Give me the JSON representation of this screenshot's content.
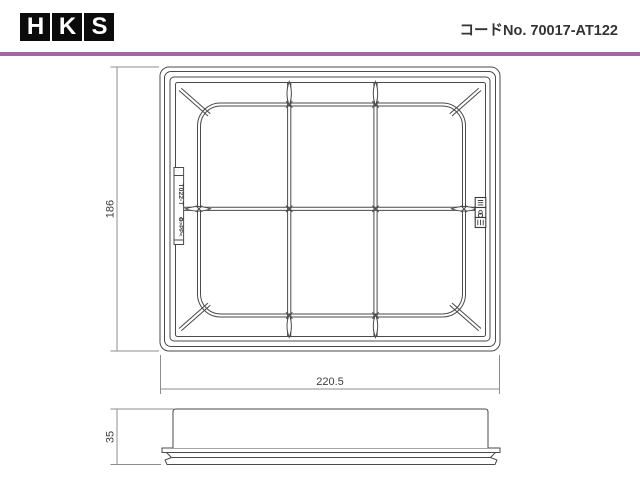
{
  "header": {
    "logo_letters": [
      "H",
      "K",
      "S"
    ],
    "code_label": "コードNo. 70017-AT122"
  },
  "colors": {
    "accent_rule": "#a763a7",
    "drawing_line": "#4a4a4a",
    "dimension_line": "#8c8c8c",
    "logo_background": "#0b0b0b"
  },
  "top_view": {
    "width_dim": "220.5",
    "height_dim": "186",
    "tab_label_top": "T022-T",
    "tab_label_bottom": "♻>PP<"
  },
  "side_view": {
    "height_dim": "35"
  }
}
